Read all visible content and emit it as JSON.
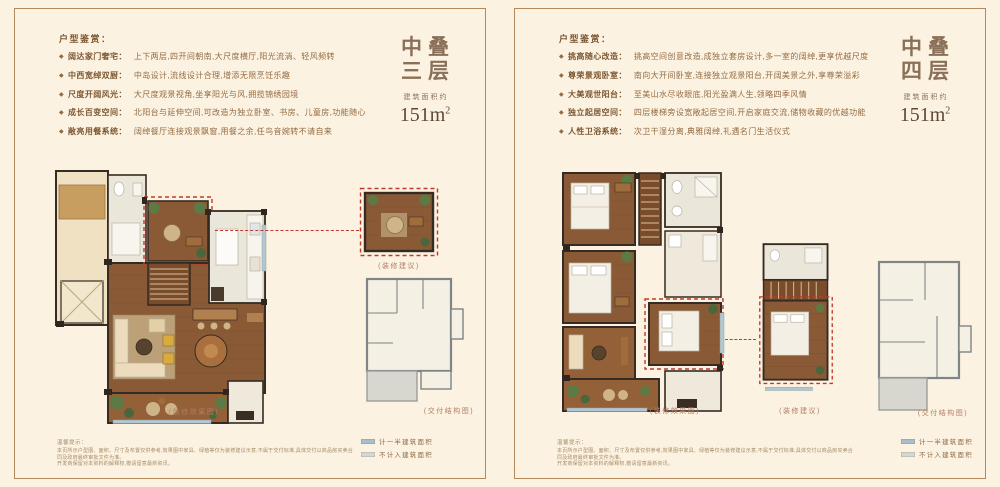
{
  "ui": {
    "bullet": "◆",
    "accent_red": "#c2392b",
    "frame_color": "#b3885c",
    "background": "#fcf2e1",
    "title_color": "#8a7058"
  },
  "panels": [
    {
      "features_heading": "户型鉴赏：",
      "features": [
        {
          "label": "阔达家门奢宅：",
          "text": "上下两层,四开间朝南,大尺度横厅,阳光流淌、轻风频转"
        },
        {
          "label": "中西宽绰双厨：",
          "text": "中岛设计,流线设计合理,增添无限烹饪乐趣"
        },
        {
          "label": "尺度开阔风光：",
          "text": "大尺度观景视角,坐享阳光与风,拥揽锦绣园境"
        },
        {
          "label": "成长百变空间：",
          "text": "北阳台与延伸空间,可改造为独立卧室、书房、儿童房,功能随心"
        },
        {
          "label": "敞亮用餐系统：",
          "text": "阔绰餐厅连接观景飘窗,用餐之余,任鸟音婉转不请自来"
        }
      ],
      "title_line1": "中叠",
      "title_line2": "三层",
      "area_label": "建筑面积约",
      "area_value": "151m",
      "area_unit_sup": "2",
      "caption_main": "(装修效果图)",
      "caption_suggest": "(装修建议)",
      "caption_delivery": "(交付结构图)",
      "disclaimer_heading": "温馨提示：",
      "disclaimer_line1": "本页所示户型图、面积、尺寸及布置仅供参考,效果图中家具、绿植等仅为装修建议示意,不属于交付标准,具体交付以商品房买卖合同及政府最终审批文件为准。",
      "disclaimer_line2": "开发商保留对本资料的解释权,敬请留意最新资讯。",
      "legend": [
        {
          "label": "计一半建筑面积",
          "color": "#a9bec9"
        },
        {
          "label": "不计入建筑面积",
          "color": "#d6d5ce"
        }
      ]
    },
    {
      "features_heading": "户型鉴赏：",
      "features": [
        {
          "label": "挑高随心改造：",
          "text": "挑高空间创意改造,成独立套房设计,多一室的阔绰,更享优越尺度"
        },
        {
          "label": "尊荣景观卧室：",
          "text": "南向大开间卧室,连接独立观景阳台,开阔美景之外,享尊荣溢彩"
        },
        {
          "label": "大美观世阳台：",
          "text": "至美山水尽收眼底,阳光盈满人生,领略四季风情"
        },
        {
          "label": "独立起居空间：",
          "text": "四层楼梯旁设宽敞起居空间,开启家庭交流,储物收藏的优越功能"
        },
        {
          "label": "人性卫浴系统：",
          "text": "次卫干湿分离,典雅阔绰,礼遇名门生活仪式"
        }
      ],
      "title_line1": "中叠",
      "title_line2": "四层",
      "area_label": "建筑面积约",
      "area_value": "151m",
      "area_unit_sup": "2",
      "caption_main": "(装修效果图)",
      "caption_suggest": "(装修建议)",
      "caption_delivery": "(交付结构图)",
      "disclaimer_heading": "温馨提示：",
      "disclaimer_line1": "本页所示户型图、面积、尺寸及布置仅供参考,效果图中家具、绿植等仅为装修建议示意,不属于交付标准,具体交付以商品房买卖合同及政府最终审批文件为准。",
      "disclaimer_line2": "开发商保留对本资料的解释权,敬请留意最新资讯。",
      "legend": [
        {
          "label": "计一半建筑面积",
          "color": "#a9bec9"
        },
        {
          "label": "不计入建筑面积",
          "color": "#d6d5ce"
        }
      ]
    }
  ]
}
